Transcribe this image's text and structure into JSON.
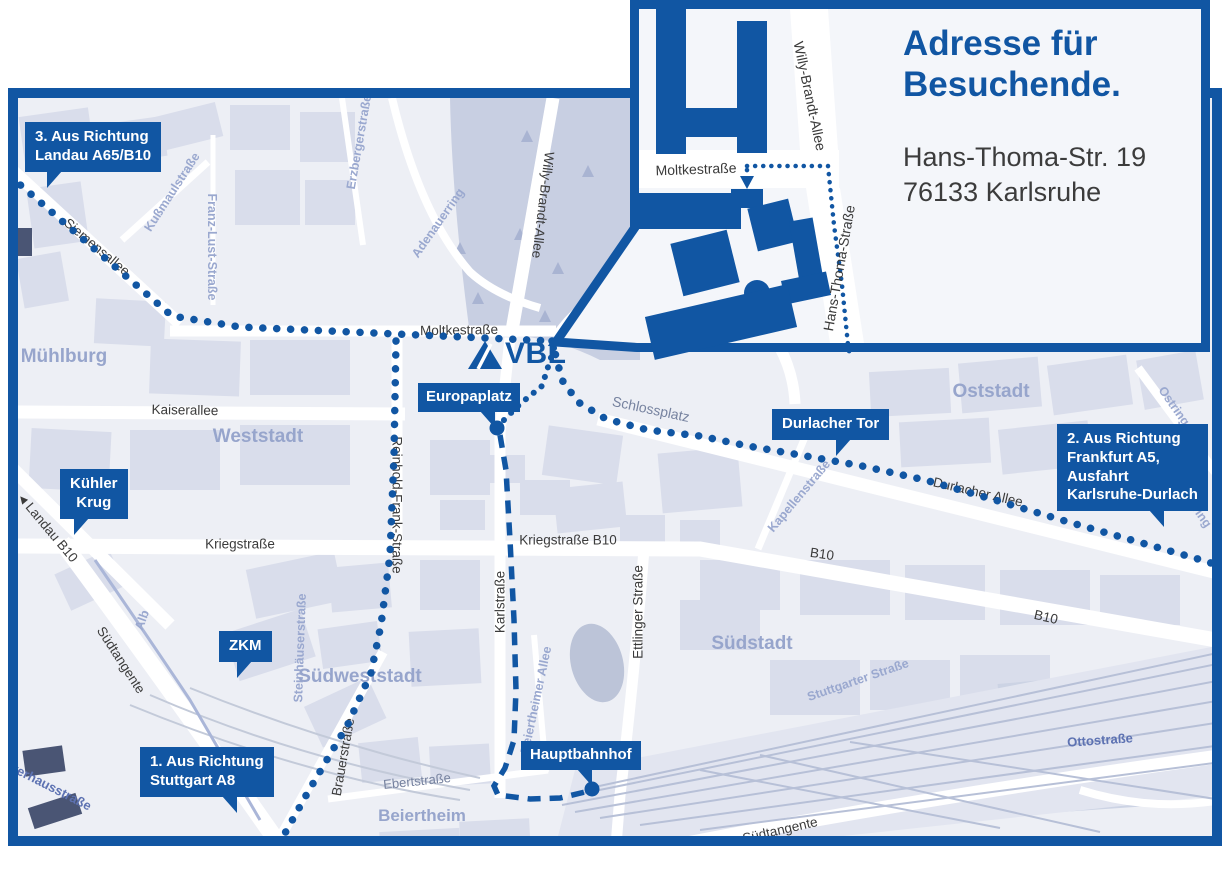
{
  "colors": {
    "primary_blue": "#1156a3",
    "map_background": "#edeff5",
    "block_fill": "#d9ddeb",
    "park_fill": "#c8cfe2",
    "road_white": "#ffffff",
    "faint_label": "#9aa8cf",
    "district_label": "#97a5cc",
    "dark_label": "#3b3b3b"
  },
  "map": {
    "logo_text": "VBL",
    "icons": {
      "direction_arrow": "◀"
    },
    "callouts": {
      "landau": "3. Aus Richtung\nLandau A65/B10",
      "frankfurt": "2. Aus Richtung\nFrankfurt A5,\nAusfahrt\nKarlsruhe-Durlach",
      "stuttgart": "1. Aus Richtung\nStuttgart A8",
      "kuehler_krug": "Kühler\nKrug",
      "zkm": "ZKM",
      "europaplatz": "Europaplatz",
      "durlacher_tor": "Durlacher Tor",
      "hauptbahnhof": "Hauptbahnhof"
    },
    "streets": {
      "siemensallee": "Siemensallee",
      "moltkestrasse": "Moltkestraße",
      "kaiserallee": "Kaiserallee",
      "kriegstrasse": "Kriegstraße",
      "kriegstrasse_b10": "Kriegstraße B10",
      "reinhold_frank_strasse": "Reinhold-Frank-Straße",
      "karlstrasse": "Karlstraße",
      "ettlinger_strasse": "Ettlinger Straße",
      "willy_brandt_allee": "Willy-Brandt-Allee",
      "durlacher_allee": "Durlacher Allee",
      "b10": "B10",
      "suedtangente": "Südtangente",
      "landau_b10": "Landau B10",
      "brauerstrasse": "Brauerstraße",
      "ebertstrasse": "Ebertstraße",
      "schlossplatz": "Schlossplatz",
      "kussmaulstrasse": "Kußmaulstraße",
      "franz_lust_strasse": "Franz-Lust-Straße",
      "erzbergerstrasse": "Erzbergerstraße",
      "adenauerring": "Adenauerring",
      "kapellenstrasse": "Kapellenstraße",
      "ostring": "Ostring",
      "stuttgarter_strasse": "Stuttgarter Straße",
      "alb": "Alb",
      "steinhaeuserstrasse": "Steinhäuserstraße",
      "beiertheimer_allee": "Beiertheimer Allee",
      "ottostrasse": "Ottostraße",
      "pulverhausstrasse": "Pulverhausstraße"
    },
    "districts": {
      "muehlburg": "Mühlburg",
      "weststadt": "Weststadt",
      "oststadt": "Oststadt",
      "suedstadt": "Südstadt",
      "suedweststadt": "Südweststadt",
      "beiertheim": "Beiertheim"
    }
  },
  "inset": {
    "title": "Adresse für\nBesuchende.",
    "address": "Hans-Thoma-Str. 19\n76133 Karlsruhe",
    "streets": {
      "moltkestrasse": "Moltkestraße",
      "willy_brandt_allee": "Willy-Brandt-Allee",
      "hans_thoma_strasse": "Hans-Thoma-Straße"
    }
  }
}
